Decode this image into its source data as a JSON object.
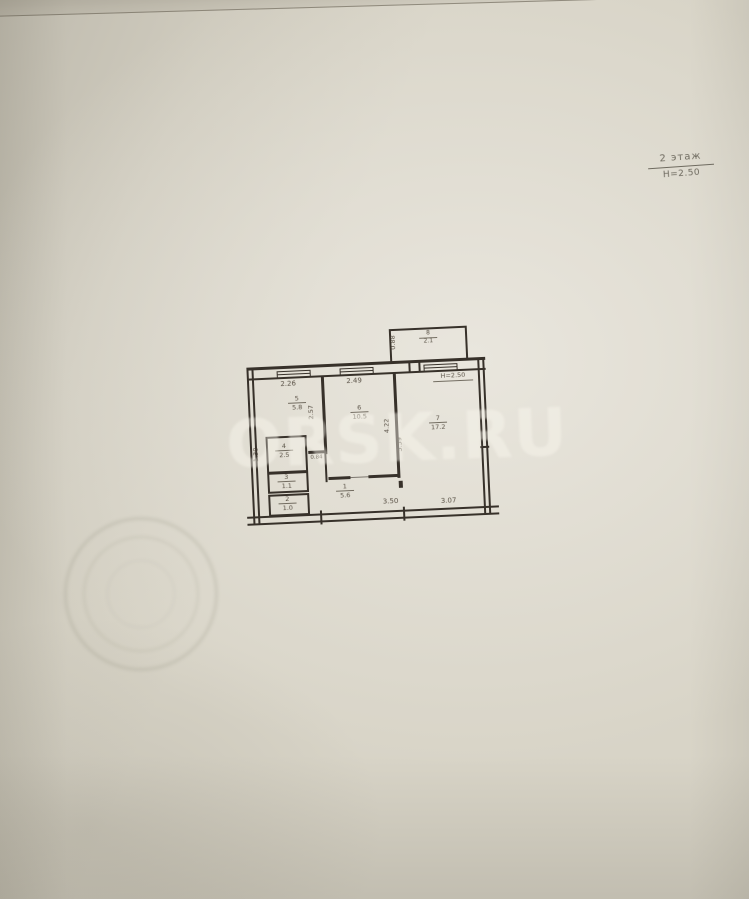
{
  "header": {
    "floor": "2 этаж",
    "height": "Н=2.50"
  },
  "watermark": {
    "text": "ORSK.RU"
  },
  "plan": {
    "height_note": "Н=2.50",
    "rooms": {
      "r1": {
        "num": "1",
        "area": "5.6"
      },
      "r2": {
        "num": "2",
        "area": "1.0"
      },
      "r3": {
        "num": "3",
        "area": "1.1"
      },
      "r4": {
        "num": "4",
        "area": "2.5"
      },
      "r5": {
        "num": "5",
        "area": "5.8"
      },
      "r6": {
        "num": "6",
        "area": "10.5"
      },
      "r7": {
        "num": "7",
        "area": "17.2"
      },
      "balcony": {
        "num": "8",
        "area": "2.1"
      }
    },
    "dims": {
      "top_left": "2.26",
      "top_mid": "2.49",
      "bottom_mid": "3.50",
      "bottom_right": "3.07",
      "r5_depth": "2.57",
      "r6_depth": "4.22",
      "r7_depth": "5.59",
      "balcony_depth": "0.88",
      "r4_width": "1.38",
      "stub_width": "0.84"
    }
  },
  "colors": {
    "ink": "#37312a",
    "paper": "#d8d4c7",
    "watermark": "rgba(250,247,238,0.42)"
  }
}
